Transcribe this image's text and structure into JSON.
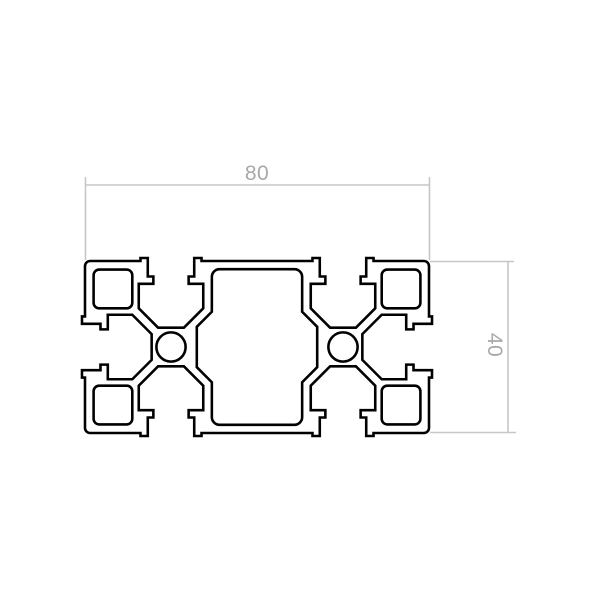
{
  "drawing": {
    "dimensions": {
      "width_label": "80",
      "height_label": "40"
    },
    "colors": {
      "outline": "#000000",
      "dimension_line": "#c7c7c7",
      "dimension_text": "#a8a8a8",
      "background": "#ffffff"
    }
  }
}
